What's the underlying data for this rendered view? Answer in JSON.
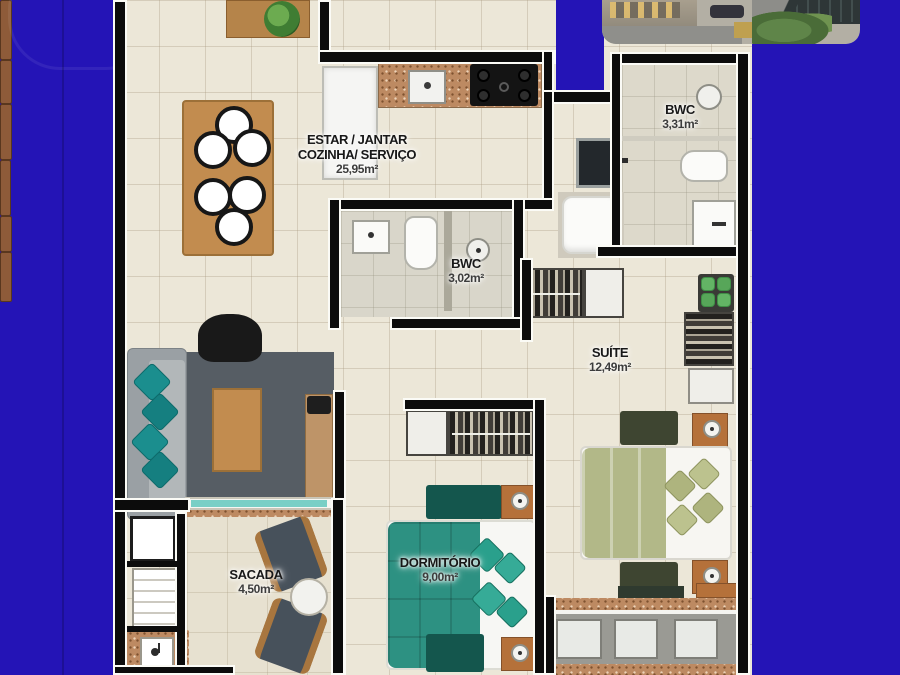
{
  "colors": {
    "background": "#2414b6",
    "wall": "#0c0c0c",
    "floor": "#ece7d8",
    "teal_bed": "#2d9182",
    "olive_bed": "#b2b888",
    "wood": "#c28c4f"
  },
  "rooms": {
    "living": {
      "name_line1": "ESTAR / JANTAR",
      "name_line2": "COZINHA/ SERVIÇO",
      "area": "25,95m²"
    },
    "bwc_top": {
      "name": "BWC",
      "area": "3,31m²"
    },
    "bwc_middle": {
      "name": "BWC",
      "area": "3,02m²"
    },
    "suite": {
      "name": "SUÍTE",
      "area": "12,49m²"
    },
    "dormitorio": {
      "name": "DORMITÓRIO",
      "area": "9,00m²"
    },
    "sacada": {
      "name": "SACADA",
      "area": "4,50m²"
    }
  }
}
